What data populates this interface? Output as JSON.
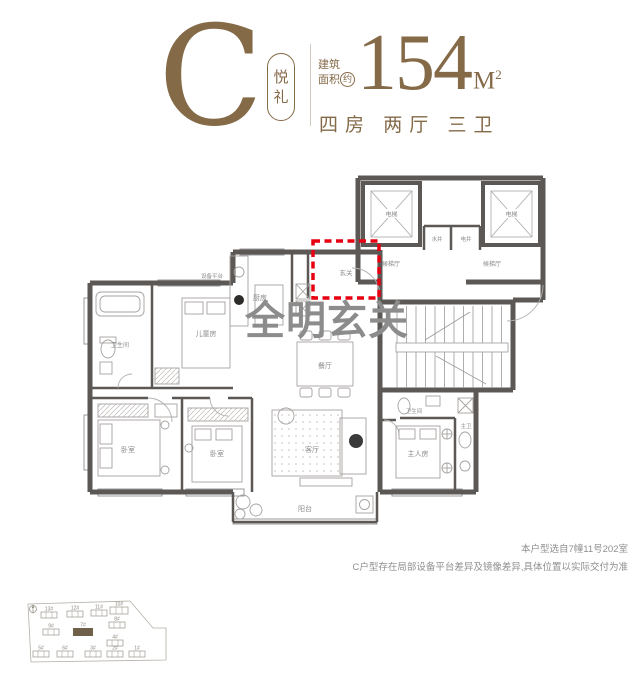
{
  "header": {
    "type_letter": "C",
    "type_name_char1": "悦",
    "type_name_char2": "礼",
    "area_prefix_line1": "建筑",
    "area_prefix_line2": "面积",
    "area_prefix_circled": "约",
    "area_value": "154",
    "area_unit": "M",
    "area_unit_exp": "2",
    "layout_desc": "四房 两厅 三卫"
  },
  "annotation": {
    "highlight": "全明玄关"
  },
  "floorplan": {
    "rooms": {
      "foyer": "玄关",
      "kitchen": "厨房",
      "dining": "餐厅",
      "living": "客厅",
      "balcony": "阳台",
      "kids_room": "儿童房",
      "bedroom": "卧室",
      "master_room": "主人房",
      "bathroom": "卫生间",
      "master_bath": "主卫",
      "elevator": "电梯",
      "elevator_hall": "候梯厅",
      "water_shaft": "水井",
      "electric_shaft": "电井",
      "equipment_platform": "设备平台"
    }
  },
  "disclaimer": {
    "line1": "本户型选自7幢11号202室",
    "line2": "C户型存在局部设备平台差异及镜像差异,具体位置以实际交付为准"
  },
  "siteplan": {
    "buildings": [
      {
        "label": "13#"
      },
      {
        "label": "12#"
      },
      {
        "label": "11#"
      },
      {
        "label": "10#"
      },
      {
        "label": "9#"
      },
      {
        "label": "7#"
      },
      {
        "label": "8#"
      },
      {
        "label": "4#"
      },
      {
        "label": "5#"
      },
      {
        "label": "6#"
      },
      {
        "label": "3#"
      },
      {
        "label": "2#"
      },
      {
        "label": "1#"
      }
    ],
    "highlighted_building": "7#"
  },
  "colors": {
    "accent_gold": "#856a48",
    "highlight_red": "#e60012",
    "wall_gray": "#5b5855"
  }
}
